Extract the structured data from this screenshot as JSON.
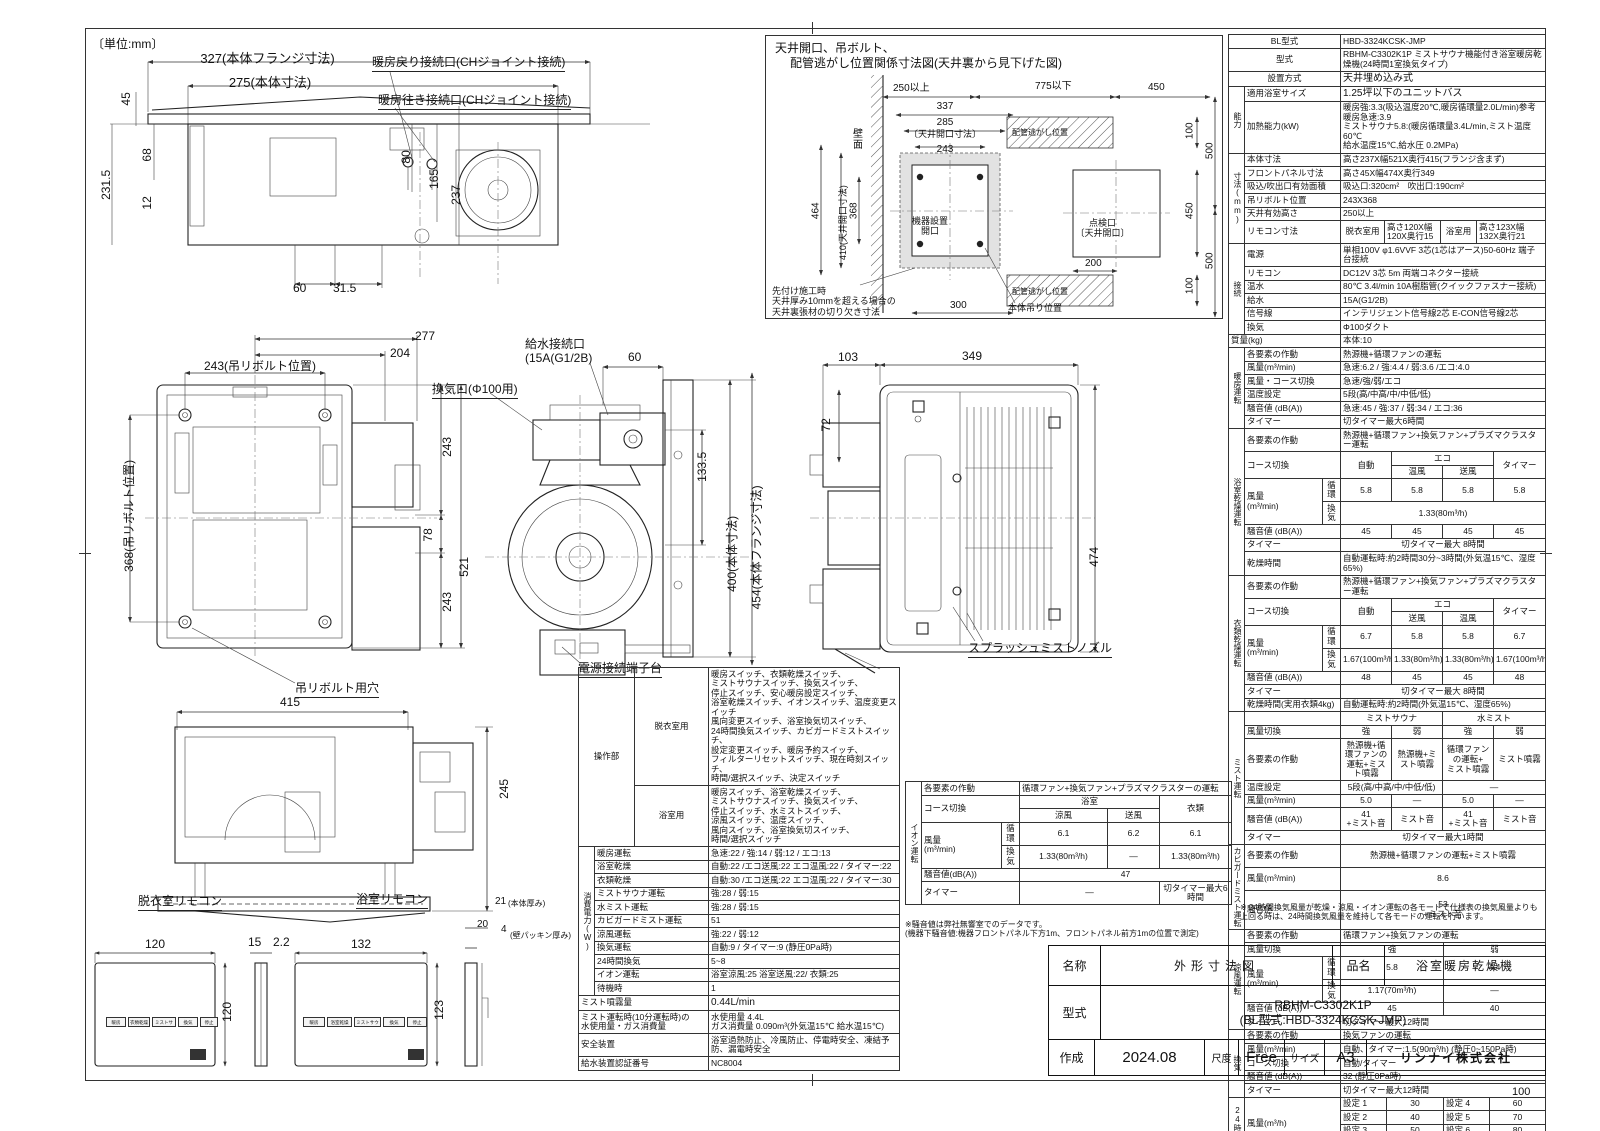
{
  "page": {
    "unit": "〔単位:mm〕",
    "num": "100"
  },
  "d1": {
    "t": [
      "327(本体フランジ寸法)",
      "275(本体寸法)",
      "45",
      "68",
      "12",
      "231.5",
      "80",
      "165",
      "237",
      "60",
      "31.5"
    ],
    "c": [
      "暖房戻り接続口(CHジョイント接続)",
      "暖房往き接続口(CHジョイント接続)"
    ]
  },
  "d2": {
    "title1": "天井開口、吊ボルト、",
    "title2": "配管逃がし位置関係寸法図(天井裏から見下げた図)",
    "t": [
      "250以上",
      "775以下",
      "450",
      "337",
      "285",
      "〔天井開口寸法〕",
      "243",
      "464",
      "410(天井開口寸法)",
      "368",
      "100",
      "500",
      "450",
      "100",
      "500",
      "200",
      "300"
    ],
    "wall": "壁面",
    "pipe1": "配管逃がし位置",
    "pipe2": "配管逃がし位置",
    "opening": "機器設置\n開口",
    "inspection": "点検口\n〔天井開口〕",
    "hang": "本体吊り位置",
    "note": "先付け施工時\n天井厚み10mmを超える場合の\n天井裏張材の切り欠き寸法"
  },
  "d3": {
    "t": [
      "277",
      "204",
      "243(吊リボルト位置)",
      "368(吊リボルト位置)",
      "243",
      "78",
      "243",
      "521"
    ],
    "hole": "吊リボルト用穴"
  },
  "d4": {
    "kyusui": "給水接続口\n(15A(G1/2B)",
    "kanko": "換気口(Φ100用)",
    "dengen": "電源接続端子台",
    "t": [
      "60",
      "133.5",
      "400(本体寸法)",
      "454(本体フランジ寸法)"
    ]
  },
  "d5": {
    "t": [
      "103",
      "349",
      "72",
      "474"
    ],
    "nozzle": "スプラッシュミストノズル"
  },
  "d6": {
    "t": [
      "415",
      "245"
    ]
  },
  "d7": {
    "title1": "脱衣室リモコン",
    "title2": "浴室リモコン",
    "t": [
      "120",
      "15",
      "2.2",
      "120",
      "132",
      "123",
      "21",
      "(本体厚み)",
      "20",
      "4",
      "(壁パッキン厚み)"
    ],
    "btns1": [
      "暖房",
      "衣類乾燥",
      "ミストサウナ",
      "換気",
      "停止"
    ],
    "btns2": [
      "暖房",
      "浴室乾燥",
      "ミストサウナ",
      "換気",
      "停止"
    ]
  },
  "spec": {
    "bl_l": "BL型式",
    "bl_v": "HBD-3324KCSK-JMP",
    "kata_l": "型式",
    "kata_v": "RBHM-C3302K1P ミストサウナ機能付き浴室暖房乾燥機(24時間1室換気タイプ)",
    "setti_l": "設置方式",
    "setti_v": "天井埋め込み式",
    "noryoku": {
      "g": "能力",
      "l1": "適用浴室サイズ",
      "v1": "1.25坪以下のユニットバス",
      "l2": "加熱能力(kW)",
      "v2": "暖房強:3.3(吸込温度20℃,暖房循環量2.0L/min)参考 暖房急速:3.9\nミストサウナ5.8:(暖房循環量3.4L/min,ミスト温度60℃\n給水温度15℃,給水圧 0.2MPa)"
    },
    "sunpo": {
      "g": "寸法(mm)",
      "rows": [
        [
          "本体寸法",
          "高さ237X幅521X奥行415(フランジ含まず)"
        ],
        [
          "フロントパネル寸法",
          "高さ45X幅474X奥行349"
        ],
        [
          "吸込/吹出口有効面積",
          "吸込口:320cm²　吹出口:190cm²"
        ],
        [
          "吊リボルト位置",
          "243X368"
        ],
        [
          "天井有効高さ",
          "250以上"
        ]
      ],
      "remo_l": "リモコン寸法",
      "remo": [
        "脱衣室用",
        "高さ120X幅120X奥行15",
        "浴室用",
        "高さ123X幅132X奥行21"
      ]
    },
    "setsu": {
      "g": "接続",
      "rows": [
        [
          "電源",
          "単相100V φ1.6VVF 3芯(1芯はアース)50-60Hz 端子台接続"
        ],
        [
          "リモコン",
          "DC12V 3芯 5m 両端コネクター接続"
        ],
        [
          "温水",
          "80℃ 3.4l/min 10A樹脂管(クイックファスナー接続)"
        ],
        [
          "給水",
          "15A(G1/2B)"
        ],
        [
          "信号線",
          "インテリジェント信号線2芯 E-CON信号線2芯"
        ],
        [
          "換気",
          "Φ100ダクト"
        ]
      ]
    },
    "mass_l": "質量(kg)",
    "mass_v": "本体:10",
    "danbo": {
      "g": "暖房運転",
      "rows": [
        [
          "各要素の作動",
          "熱源機+循環ファンの運転"
        ],
        [
          "風量(m³/min)",
          "急速:6.2 / 強:4.4 / 弱:3.6 /エコ:4.0"
        ],
        [
          "風量・コース切換",
          "急速/強/弱/エコ"
        ],
        [
          "温度設定",
          "5段(高/中高/中/中低/低)"
        ],
        [
          "騒音値 (dB(A))",
          "急速:45 / 強:37 / 弱:34 / エコ:36"
        ],
        [
          "タイマー",
          "切タイマー最大6時間"
        ]
      ]
    },
    "yoku": {
      "g": "浴室乾燥運転",
      "sakudo_l": "各要素の作動",
      "sakudo_v": "熱源機+循環ファン+換気ファン+プラズマクラスター運転",
      "course_l": "コース切換",
      "auto": "自動",
      "eco": "エコ",
      "e1": "温風",
      "e2": "送風",
      "timer": "タイマー",
      "furyo_l": "風量\n(m³/min)",
      "junkan": "循環",
      "kanki": "換気",
      "jv": [
        "5.8",
        "5.8",
        "5.8",
        "5.8"
      ],
      "kv": "1.33(80m³/h)",
      "soon_l": "騒音値 (dB(A))",
      "sv": [
        "45",
        "45",
        "45",
        "45"
      ],
      "timer_l": "タイマー",
      "timer_v": "切タイマー最大 8時間",
      "kanso_l": "乾燥時間",
      "kanso_v": "自動運転時:約2時間30分~3時間(外気温15℃、湿度65%)"
    },
    "irui": {
      "g": "衣類乾燥運転",
      "sakudo_l": "各要素の作動",
      "sakudo_v": "熱源機+循環ファン+換気ファン+プラズマクラスター運転",
      "course_l": "コース切換",
      "auto": "自動",
      "eco": "エコ",
      "e1": "送風",
      "e2": "温風",
      "timer": "タイマー",
      "furyo_l": "風量\n(m³/min)",
      "junkan": "循環",
      "kanki": "換気",
      "jv": [
        "6.7",
        "5.8",
        "5.8",
        "6.7"
      ],
      "kv": [
        "1.67(100m³/h)",
        "1.33(80m³/h)",
        "1.33(80m³/h)",
        "1.67(100m³/h)"
      ],
      "soon_l": "騒音値 (dB(A))",
      "sv": [
        "48",
        "45",
        "45",
        "48"
      ],
      "timer_l": "タイマー",
      "timer_v": "切タイマー最大 8時間",
      "kanso_l": "乾燥時間(実用衣類4kg)",
      "kanso_v": "自動運転時:約2時間(外気温15℃、湿度65%)"
    },
    "mist": {
      "g": "ミスト運転",
      "h1": "ミストサウナ",
      "h2": "水ミスト",
      "kiri_l": "風量切換",
      "kiri": [
        "強",
        "弱",
        "強",
        "弱"
      ],
      "sakudo_l": "各要素の作動",
      "sakudo": [
        "熱源機+循環ファンの\n運転+ミスト噴霧",
        "熱源機+ミスト噴霧",
        "循環ファン\nの運転+\nミスト噴霧",
        "ミスト噴霧"
      ],
      "ondo_l": "温度設定",
      "ondo1": "5段(高/中高/中/中低/低)",
      "ondo2": "―",
      "furyo_l": "風量(m³/min)",
      "fv": [
        "5.0",
        "―",
        "5.0",
        "―"
      ],
      "soon_l": "騒音値 (dB(A))",
      "sv": [
        "41\n+ミスト音",
        "ミスト音",
        "41\n+ミスト音",
        "ミスト音"
      ],
      "timer_l": "タイマー",
      "timer_v": "切タイマー最大1時間"
    },
    "kabi": {
      "g": "カビガードミスト運転",
      "rows": [
        [
          "各要素の作動",
          "熱源機+循環ファンの運転+ミスト噴霧"
        ],
        [
          "風量(m³/min)",
          "8.6"
        ],
        [
          "騒音値",
          "53\n+ミスト音"
        ]
      ]
    },
    "ryofu": {
      "g": "涼風運転",
      "sakudo_l": "各要素の作動",
      "sakudo_v": "循環ファン+換気ファンの運転",
      "kiri_l": "風量切換",
      "k1": "強",
      "k2": "弱",
      "furyo_l": "風量\n(m³/min)",
      "junkan": "循環",
      "kanki": "換気",
      "j1": "5.8",
      "j2": "4.4",
      "ka1": "1.17(70m³/h)",
      "ka2": "―",
      "soon_l": "騒音値 (dB(A))",
      "s1": "45",
      "s2": "40",
      "timer_l": "タイマー",
      "timer_v": "切タイマー最大12時間"
    },
    "kanki": {
      "g": "換気",
      "rows": [
        [
          "各要素の作動",
          "換気ファンの運転"
        ],
        [
          "風量(m³/min)",
          "自動、タイマー:1.5(90m³/h) (静圧0~150Pa時)"
        ],
        [
          "コース切換",
          "自動/タイマー"
        ],
        [
          "騒音値 (dB(A))",
          "32 (静圧0Pa時)"
        ],
        [
          "タイマー",
          "切タイマー最大12時間"
        ]
      ]
    },
    "h24": {
      "g": "24時間換気",
      "furyo_l": "風量(m³/h)",
      "sets": [
        [
          "設定 1",
          "30",
          "設定 4",
          "60"
        ],
        [
          "設定 2",
          "40",
          "設定 5",
          "70"
        ],
        [
          "設定 3",
          "50",
          "設定 6",
          "80"
        ]
      ],
      "factory": "工場出荷時 60",
      "soon_l": "騒音値 (dB(A))",
      "soon_v": "23~30(静圧0Pa時)"
    },
    "note": "※ 24時間換気風量が乾燥・涼風・イオン運転の各モードで仕様表の換気風量よりも\n上回る時は、24時間換気風量を維持して各モードの運転を行います。"
  },
  "ops": {
    "sousa_g": "操作部",
    "datsui_l": "脱衣室用",
    "datsui_v": "暖房スイッチ、衣類乾燥スイッチ、\nミストサウナスイッチ、換気スイッチ、\n停止スイッチ、安心暖房設定スイッチ、\n浴室乾燥スイッチ、イオンスイッチ、温度変更スイッチ\n風向変更スイッチ、浴室換気切スイッチ、\n24時間換気スイッチ、カビガードミストスイッチ、\n設定変更スイッチ、暖房予約スイッチ、\nフィルターリセットスイッチ、現在時刻スイッチ、\n時間/選択スイッチ、決定スイッチ",
    "yoku_l": "浴室用",
    "yoku_v": "暖房スイッチ、浴室乾燥スイッチ、\nミストサウナスイッチ、換気スイッチ、\n停止スイッチ、水ミストスイッチ、\n涼風スイッチ、温度スイッチ、\n風向スイッチ、浴室換気切スイッチ、\n時間/選択スイッチ",
    "power_g": "消費電力(W)",
    "rows": [
      [
        "暖房運転",
        "急速:22 / 強:14 / 弱:12 / エコ:13"
      ],
      [
        "浴室乾燥",
        "自動:22 /エコ送風:22 エコ温風:22 / タイマー:22"
      ],
      [
        "衣類乾燥",
        "自動:30 /エコ送風:22 エコ温風:22 / タイマー:30"
      ],
      [
        "ミストサウナ運転",
        "強:28 / 弱:15"
      ],
      [
        "水ミスト運転",
        "強:28 / 弱:15"
      ],
      [
        "カビガードミスト運転",
        "51"
      ],
      [
        "涼風運転",
        "強:22 / 弱:12"
      ],
      [
        "換気運転",
        "自動:9 / タイマー:9 (静圧0Pa時)"
      ],
      [
        "24時間換気",
        "5~8"
      ],
      [
        "イオン運転",
        "浴室涼風:25 浴室送風:22/ 衣類:25"
      ],
      [
        "待機時",
        "1"
      ]
    ],
    "mist_l": "ミスト噴霧量",
    "mist_v": "0.44L/min",
    "water_l": "ミスト運転時(10分運転時)の\n水使用量・ガス消費量",
    "water_v": "水使用量 4.4L\nガス消費量 0.090m³(外気温15℃ 給水温15℃)",
    "safe_l": "安全装置",
    "safe_v": "浴室過熱防止、冷風防止、停電時安全、凍結予防、漏電時安全",
    "cert_l": "給水装置認証番号",
    "cert_v": "NC8004"
  },
  "ion": {
    "g": "イオン運転",
    "sakudo_l": "各要素の作動",
    "sakudo_v": "循環ファン+換気ファン+プラズマクラスターの運転",
    "course_l": "コース切換",
    "yoku": "浴室",
    "ryofu": "涼風",
    "sofu": "送風",
    "irui": "衣類",
    "furyo_l": "風量\n(m³/min)",
    "junkan": "循環",
    "kanki": "換気",
    "j": [
      "6.1",
      "6.2",
      "6.1"
    ],
    "k": [
      "1.33(80m³/h)",
      "―",
      "1.33(80m³/h)"
    ],
    "soon_l": "騒音値(dB(A))",
    "soon_v": "47",
    "timer_l": "タイマー",
    "t1": "―",
    "t2": "切タイマー最大6時間",
    "note": "※騒音値は弊社無響室でのデータです。\n(機器下騒音値:機器フロントパネル下方1m、フロントパネル前方1mの位置で測定)"
  },
  "tb": {
    "meisho_l": "名称",
    "meisho_v": "外形寸法図",
    "hinmei_l": "品名",
    "hinmei_v": "浴室暖房乾燥機",
    "kata_l": "型式",
    "kata_v": "RBHM-C3302K1P\n(BL型式:HBD-3324KCSK-JMP)",
    "sakusei_l": "作成",
    "date": "2024.08",
    "shakudo_l": "尺度",
    "shakudo_v": "Free",
    "size_l": "サイズ",
    "size_v": "A3",
    "company": "リンナイ株式会社"
  }
}
